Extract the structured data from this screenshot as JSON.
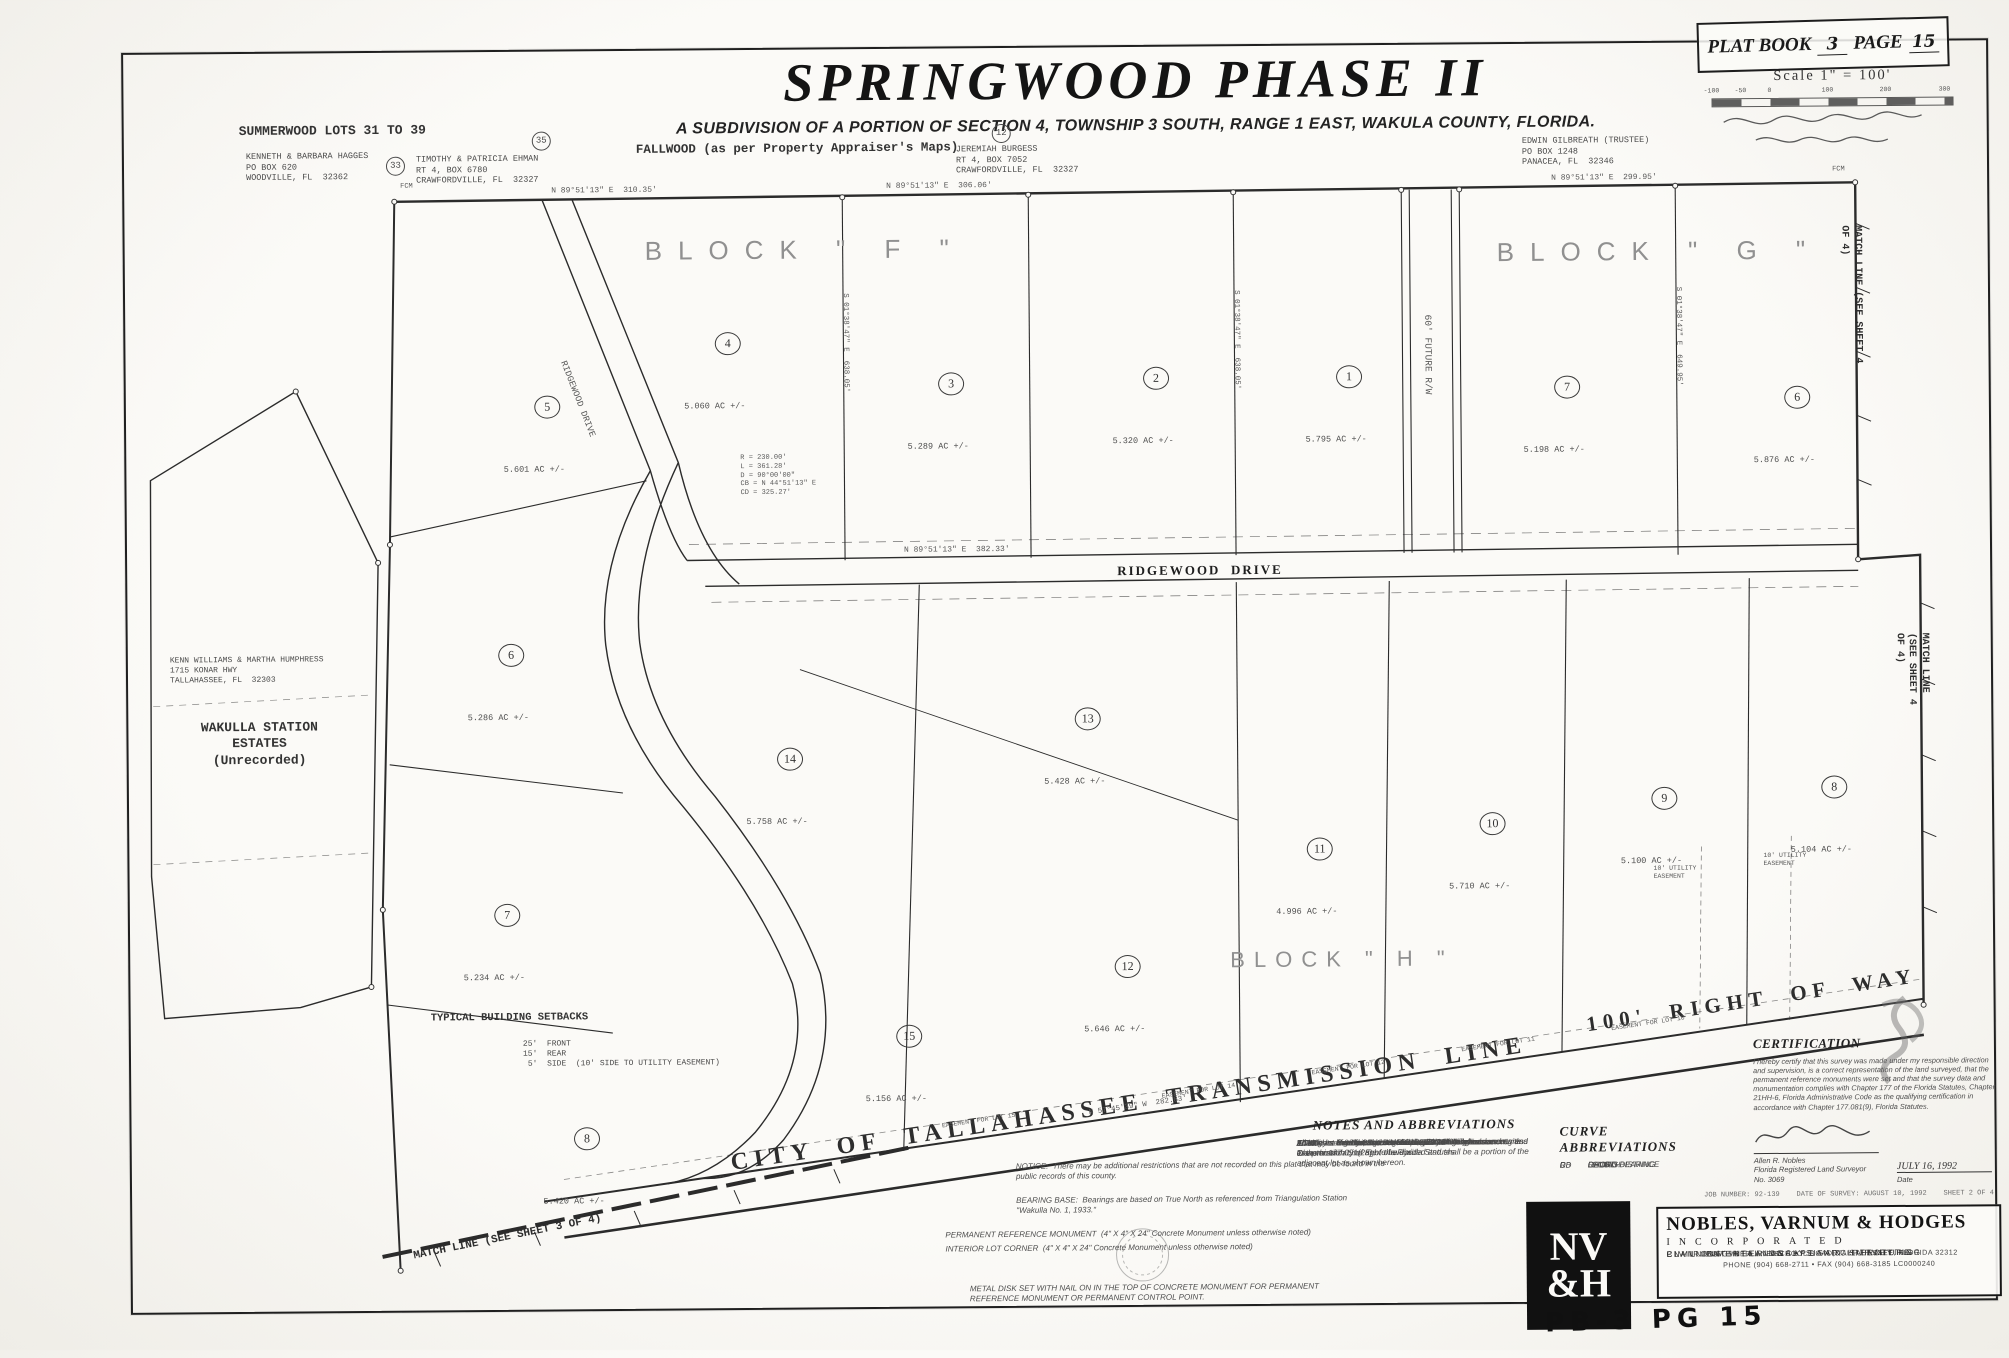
{
  "title": {
    "main": "SPRINGWOOD PHASE II",
    "subtitle": "A SUBDIVISION OF A PORTION OF SECTION 4, TOWNSHIP 3 SOUTH, RANGE 1 EAST, WAKULA COUNTY, FLORIDA."
  },
  "plat_box": {
    "label_book": "PLAT BOOK",
    "book": "3",
    "label_page": "PAGE",
    "page": "15"
  },
  "scale": {
    "label": "Scale  1\" = 100'",
    "ticks": [
      {
        "t": "-100",
        "x": 0
      },
      {
        "t": "-50",
        "x": 29
      },
      {
        "t": "0",
        "x": 58
      },
      {
        "t": "100",
        "x": 116
      },
      {
        "t": "200",
        "x": 174
      },
      {
        "t": "300",
        "x": 233
      }
    ]
  },
  "lots": [
    {
      "num": "5",
      "ac": "5.601 AC +/-",
      "x": 536,
      "y": 372
    },
    {
      "num": "4",
      "ac": "5.060 AC +/-",
      "x": 717,
      "y": 310
    },
    {
      "num": "3",
      "ac": "5.289 AC +/-",
      "x": 940,
      "y": 352
    },
    {
      "num": "2",
      "ac": "5.320 AC +/-",
      "x": 1145,
      "y": 348
    },
    {
      "num": "1",
      "ac": "5.795 AC +/-",
      "x": 1338,
      "y": 348
    },
    {
      "num": "7",
      "ac": "5.198 AC +/-",
      "x": 1556,
      "y": 360
    },
    {
      "num": "6",
      "ac": "5.876 AC +/-",
      "x": 1786,
      "y": 372
    },
    {
      "num": "6",
      "ac": "5.286 AC +/-",
      "x": 498,
      "y": 620
    },
    {
      "num": "14",
      "ac": "5.758 AC +/-",
      "x": 776,
      "y": 726
    },
    {
      "num": "13",
      "ac": "5.428 AC +/-",
      "x": 1074,
      "y": 688
    },
    {
      "num": "11",
      "ac": "4.996 AC +/-",
      "x": 1305,
      "y": 820
    },
    {
      "num": "10",
      "ac": "5.710 AC +/-",
      "x": 1478,
      "y": 796
    },
    {
      "num": "9",
      "ac": "5.100 AC +/-",
      "x": 1650,
      "y": 772
    },
    {
      "num": "8",
      "ac": "5.104 AC +/-",
      "x": 1820,
      "y": 762
    },
    {
      "num": "7",
      "ac": "5.234 AC +/-",
      "x": 492,
      "y": 880
    },
    {
      "num": "12",
      "ac": "5.646 AC +/-",
      "x": 1112,
      "y": 936
    },
    {
      "num": "15",
      "ac": "5.156 AC +/-",
      "x": 893,
      "y": 1004
    },
    {
      "num": "8",
      "ac": "5.420 AC +/-",
      "x": 570,
      "y": 1104
    }
  ],
  "map_texts": [
    {
      "cls": "tw-b",
      "text": "SUMMERWOOD LOTS 31 TO 39",
      "x": 243,
      "y": 118,
      "size": 13
    },
    {
      "cls": "tw",
      "text": "KENNETH & BARBARA HAGGES\nPO BOX 620\nWOODVILLE, FL  32362",
      "x": 250,
      "y": 146
    },
    {
      "cls": "tw",
      "text": "TIMOTHY & PATRICIA EHMAN\nRT 4, BOX 6780\nCRAWFORDVILLE, FL  32327",
      "x": 420,
      "y": 150
    },
    {
      "cls": "tw-b",
      "text": "FALLWOOD (as per Property Appraiser's Maps)",
      "x": 640,
      "y": 140,
      "size": 12.5
    },
    {
      "cls": "tw",
      "text": "JEREMIAH BURGESS\nRT 4, BOX 7052\nCRAWFORDVILLE, FL  32327",
      "x": 960,
      "y": 144
    },
    {
      "cls": "tw",
      "text": "EDWIN GILBREATH (TRUSTEE)\nPO BOX 1248\nPANACEA, FL  32346",
      "x": 1526,
      "y": 140
    },
    {
      "cls": "circ",
      "text": "33",
      "x": 390,
      "y": 152
    },
    {
      "cls": "circ",
      "text": "35",
      "x": 536,
      "y": 128
    },
    {
      "cls": "circ",
      "text": "12",
      "x": 996,
      "y": 124
    },
    {
      "cls": "block",
      "text": "BLOCK \" F \"",
      "x": 648,
      "y": 232,
      "size": 26
    },
    {
      "cls": "block",
      "text": "BLOCK \" G \"",
      "x": 1500,
      "y": 240,
      "size": 26
    },
    {
      "cls": "block block-sm",
      "text": "BLOCK \" H \"",
      "x": 1228,
      "y": 948,
      "size": 22
    },
    {
      "cls": "road",
      "text": "RIDGEWOOD  DRIVE",
      "x": 1118,
      "y": 564,
      "size": 13
    },
    {
      "cls": "tiny",
      "text": "RIDGEWOOD DRIVE",
      "x": 570,
      "y": 356,
      "size": 9,
      "rotate": 69
    },
    {
      "cls": "tiny",
      "text": "60' FUTURE R/W",
      "x": 1436,
      "y": 318,
      "size": 9.5,
      "rotate": 90
    },
    {
      "cls": "match",
      "text": "MATCH LINE (SEE SHEET 4 OF 4)",
      "x": 1866,
      "y": 232,
      "size": 10,
      "rotate": 90
    },
    {
      "cls": "match",
      "text": "MATCH LINE (SEE SHEET 4 OF 4)",
      "x": 1930,
      "y": 640,
      "size": 10,
      "rotate": 90
    },
    {
      "cls": "match",
      "text": "MATCH LINE (SEE SHEET 3 OF 4)",
      "x": 408,
      "y": 1246,
      "size": 11,
      "rotate": -11
    },
    {
      "cls": "big-diag",
      "text": "CITY  OF  TALLAHASSEE  TRANSMISSION  LINE",
      "x": 725,
      "y": 1146,
      "size": 24,
      "rotate": -8
    },
    {
      "cls": "big-diag",
      "text": "100'  RIGHT  OF  WAY",
      "x": 1582,
      "y": 1016,
      "size": 21,
      "rotate": -8
    },
    {
      "cls": "tw",
      "text": "KENN WILLIAMS & MARTHA HUMPHRESS\n1715 KONAR HWY\nTALLAHASSEE, FL  32303",
      "x": 170,
      "y": 650,
      "size": 8,
      "w": 175
    },
    {
      "cls": "tw-b ctr",
      "text": "WAKULLA STATION\nESTATES\n(Unrecorded)",
      "x": 184,
      "y": 714,
      "size": 13,
      "w": 150
    },
    {
      "cls": "tw-b",
      "text": "TYPICAL BUILDING SETBACKS",
      "x": 428,
      "y": 1008,
      "size": 10.5
    },
    {
      "cls": "tw",
      "text": "25'  FRONT\n15'  REAR\n 5'  SIDE  (10' SIDE TO UTILITY EASEMENT)",
      "x": 520,
      "y": 1036,
      "size": 8
    },
    {
      "cls": "tiny",
      "text": "N 89°51'13\" E  310.35'",
      "x": 555,
      "y": 183,
      "size": 8
    },
    {
      "cls": "tiny",
      "text": "N 89°51'13\" E  306.06'",
      "x": 890,
      "y": 181,
      "size": 8
    },
    {
      "cls": "tiny",
      "text": "N 89°51'13\" E  299.95'",
      "x": 1555,
      "y": 178,
      "size": 8
    },
    {
      "cls": "tiny",
      "text": "S 01°38'47\" E  638.05'",
      "x": 852,
      "y": 292,
      "size": 7.5,
      "rotate": 90
    },
    {
      "cls": "tiny",
      "text": "S 01°38'47\" E  638.05'",
      "x": 1243,
      "y": 292,
      "size": 7.5,
      "rotate": 90
    },
    {
      "cls": "tiny",
      "text": "S 01°38'47\" E  649.95'",
      "x": 1685,
      "y": 292,
      "size": 7.5,
      "rotate": 90
    },
    {
      "cls": "tiny",
      "text": "N 89°51'13\" E  382.33'",
      "x": 905,
      "y": 545,
      "size": 8
    },
    {
      "cls": "tiny",
      "text": "N 57°45'39\" W  282.83'",
      "x": 1085,
      "y": 1110,
      "size": 7.5,
      "rotate": -8
    },
    {
      "cls": "tiny",
      "text": "EASEMENT FOR LOT 15",
      "x": 938,
      "y": 1122,
      "size": 6.5,
      "rotate": -8
    },
    {
      "cls": "tiny",
      "text": "EASEMENT FOR LOT 14",
      "x": 1158,
      "y": 1094,
      "size": 6.5,
      "rotate": -8
    },
    {
      "cls": "tiny",
      "text": "EASEMENT FOR LOT 12",
      "x": 1308,
      "y": 1072,
      "size": 6.5,
      "rotate": -8
    },
    {
      "cls": "tiny",
      "text": "EASEMENT FOR LOT 11",
      "x": 1458,
      "y": 1050,
      "size": 6.5,
      "rotate": -8
    },
    {
      "cls": "tiny",
      "text": "EASEMENT FOR LOT 10",
      "x": 1608,
      "y": 1030,
      "size": 6.5,
      "rotate": -8
    },
    {
      "cls": "tiny",
      "text": "R = 230.00'\nL = 361.28'\nD = 90°00'00\"\nCB = N 44°51'13\" E\nCD = 325.27'",
      "x": 742,
      "y": 452,
      "size": 7
    },
    {
      "cls": "tiny",
      "text": "10' UTILITY\nEASEMENT",
      "x": 1652,
      "y": 870,
      "size": 6.5
    },
    {
      "cls": "tiny",
      "text": "10' UTILITY\nEASEMENT",
      "x": 1762,
      "y": 858,
      "size": 6.5
    },
    {
      "cls": "tiny",
      "text": "FCM",
      "x": 404,
      "y": 178,
      "size": 7
    },
    {
      "cls": "tiny",
      "text": "FCM",
      "x": 1836,
      "y": 172,
      "size": 7
    }
  ],
  "notes": {
    "heading": "NOTES AND ABBREVIATIONS",
    "paragraphs": [
      {
        "t": "All side lot lines are the centerline of a 20' utility easement."
      },
      {
        "t": "All lots are 5.000 acres or greater, excluding ingress and egress easements."
      },
      {
        "t": "All side lot line distances are to the centerline of easements and to the boundary of right-of-ways."
      },
      {
        "t": "All utility easements shown on this plat are in accordance with Chapter 177.091(28) of the Florida Statutes."
      },
      {
        "t": "The rights-of-way easement for the City of Tallahassee Transmission Line are to be divided and shall be a portion of the adjacent lot as shown hereon."
      }
    ],
    "abbreviations": [
      {
        "k": "FCM",
        "v": "Found Concrete Monument unnumbered"
      },
      {
        "k": "FCM #",
        "v": "Found Concrete Monument with number"
      },
      {
        "k": "SCM",
        "v": "Set Concrete Monument LB#3293"
      },
      {
        "k": "SNAD",
        "v": "Set Nail and Disk LB#3293"
      },
      {
        "k": "SIRC",
        "v": "Set Iron Rod with Cap #3293"
      },
      {
        "k": "IEDU",
        "v": "Ingress, Egress, Drainage and Utility Easement"
      }
    ]
  },
  "curves": {
    "heading": "CURVE ABBREVIATIONS",
    "rows": [
      {
        "k": "R",
        "v": "RADIUS"
      },
      {
        "k": "L",
        "v": "LENGTH"
      },
      {
        "k": "D",
        "v": "DELTA"
      },
      {
        "k": "CB",
        "v": "CHORD BEARING"
      },
      {
        "k": "CD",
        "v": "CHORD DISTANCE"
      }
    ]
  },
  "certification": {
    "heading": "CERTIFICATION",
    "body": "I hereby certify that this survey was made under my responsible direction and supervision, is a correct representation of the land surveyed, that the permanent reference monuments were set and that the survey data and monumentation complies with Chapter 177 of the Florida Statutes, Chapter 21HH-6, Florida Administrative Code as the qualifying certification in accordance with Chapter 177.081(9), Florida Statutes.",
    "name": "Allen R. Nobles\nFlorida Registered Land Surveyor\nNo. 3069",
    "date": "JULY 16, 1992",
    "date_label": "Date"
  },
  "field_notes": {
    "notice": "NOTICE:  There may be additional restrictions that are not recorded on this plat that may be found in the public records of this county.",
    "bearing_base": "BEARING BASE:  Bearings are based on True North as referenced from Triangulation Station \"Wakulla No. 1, 1933.\"",
    "prm": "PERMANENT REFERENCE MONUMENT  (4\" X 4\" X 24\" Concrete Monument unless otherwise noted)",
    "interior": "INTERIOR LOT CORNER  (4\" X 4\" X 24\" Concrete Monument unless otherwise noted)",
    "metal": "METAL DISK SET WITH NAIL ON IN THE TOP OF CONCRETE MONUMENT FOR PERMANENT REFERENCE MONUMENT OR PERMANENT CONTROL POINT."
  },
  "footer_strip": "JOB NUMBER: 92-139    DATE OF SURVEY: AUGUST 10, 1992    SHEET 2 OF 4",
  "company": {
    "name": "NOBLES, VARNUM & HODGES",
    "incorporated": "INCORPORATED",
    "services": [
      {
        "t": "CIVIL  ENGINEERING  •  LAND  SURVEYING"
      },
      {
        "t": "PLANNING  •  LANDSCAPE  ARCHITECTURE"
      },
      {
        "t": "ENVIRONMENTAL  ANALYSIS  &  PERMITTING"
      }
    ],
    "address": "3939 TIMBERLANE SCHOOL ROAD,  TALLAHASSEE,  FLORIDA  32312",
    "phone": "PHONE (904) 668-2711   •   FAX (904) 668-3185    LC0000240",
    "logo_top": "NV",
    "logo_bottom": "&H"
  },
  "page_note": "PB-3  PG 15"
}
